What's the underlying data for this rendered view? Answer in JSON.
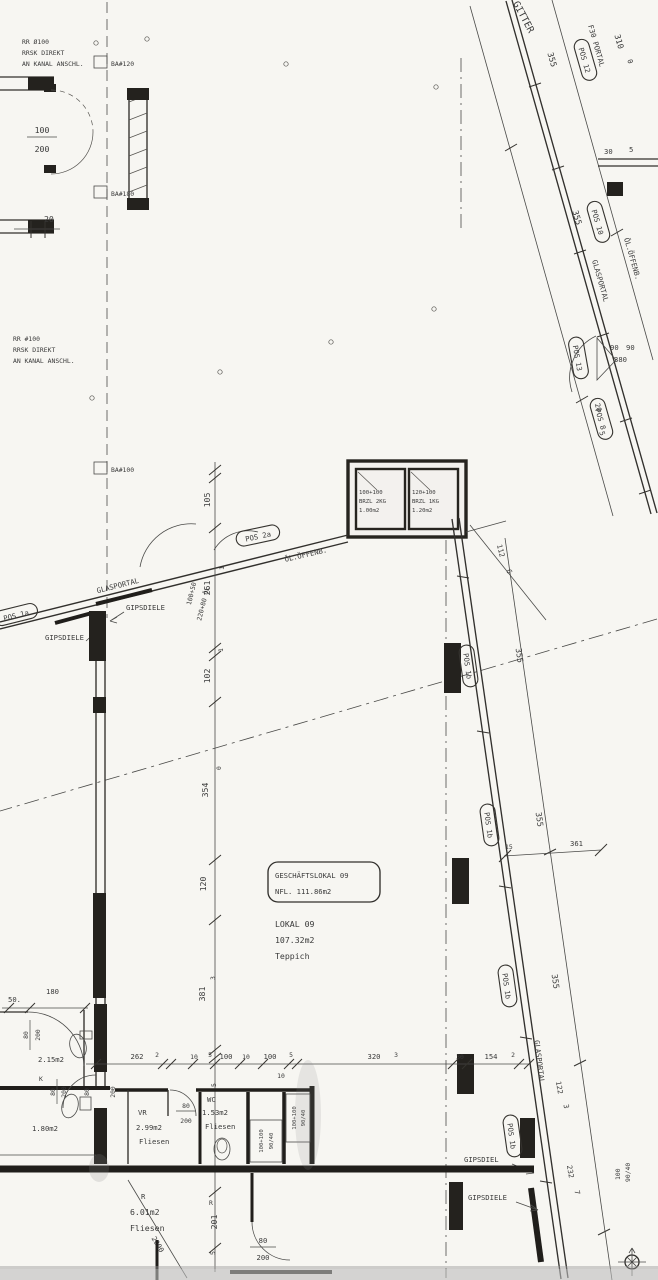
{
  "colors": {
    "ink": "#3a3a3a",
    "wall": "#201e1b",
    "paper": "#f7f6f2"
  },
  "labels": {
    "top_left": {
      "note1": [
        "RR Ø100",
        "RRSK DIREKT",
        "AN KANAL ANSCHL."
      ],
      "note2": [
        "RR #100",
        "RRSK DIREKT",
        "AN KANAL ANSCHL."
      ],
      "ba_120": "BA#120",
      "ba_180": "BA#180",
      "ba_100": "BA#100",
      "door_w": "100",
      "door_h": "200",
      "dim_20": "20"
    },
    "top_right": {
      "gitter": "GITTER",
      "f30": "F30 PORTAL",
      "d310": "310",
      "d0": "0",
      "d355_a": "355",
      "d355_b": "355",
      "pos_12": "POS 12",
      "pos_10": "POS 10",
      "pos_8": "POS 8",
      "pos_13": "POS 13",
      "glasportal": "GLASPORTAL",
      "oeffenb": "ÖL.ÖFFENB.",
      "d30": "30",
      "d5a": "5",
      "d90a": "90",
      "d90b": "90",
      "d380": "380",
      "d20": "20",
      "d5b": "5",
      "d112": "112",
      "d6": "6"
    },
    "shaft_boxes": {
      "left": [
        "100+100",
        "BRZL 2KG",
        "1.00m2"
      ],
      "right": [
        "120+100",
        "BRZL 1KG",
        "1.20m2"
      ]
    },
    "entrance": {
      "pos_1a": "POS 1a",
      "pos_2a": "POS 2a",
      "glasportal": "GLASPORTAL",
      "gipsdiele_a": "GIPSDIELE",
      "gipsdiele_b": "GIPSDIELE",
      "oeffenb": "ÖL.ÖFFENB.",
      "door_a": "100+50",
      "door_b": "220+80 ÖL"
    },
    "vchain": {
      "d105": "105",
      "s1a": "1",
      "d261": "261",
      "s1b": "1",
      "d102": "102",
      "s0": "0",
      "d354": "354",
      "d120": "120",
      "s3": "3",
      "d381": "381",
      "s5a": "5",
      "sR": "R",
      "d201": "201",
      "s5b": "5"
    },
    "room": {
      "title": "GESCHÄFTSLOKAL 09",
      "nfl": "NFL. 111.86m2",
      "lokal": "LOKAL 09",
      "area": "107.32m2",
      "floor": "Teppich"
    },
    "right_wall": {
      "pos_1b_1": "POS 1b",
      "pos_1b_2": "POS 1b",
      "pos_1b_3": "POS 1b",
      "pos_1b_4": "POS 1b",
      "d355_1": "355",
      "d355_2": "355",
      "d355_3": "355",
      "d361": "361",
      "d15": "15",
      "glasportal": "GLASPORTAL",
      "d122": "122",
      "s3": "3",
      "d232": "232",
      "s7": "7",
      "gipsdiel": "GIPSDIEL",
      "gipsdiele": "GIPSDIELE",
      "shaft_a": "100",
      "shaft_b": "90/40"
    },
    "hchain": {
      "d262": "262",
      "s2a": "2",
      "d10a": "10",
      "s5a": "5",
      "d100a": "100",
      "d10b": "10",
      "d100b": "100",
      "s5b": "5",
      "b10": "10",
      "d320": "320",
      "s3": "3",
      "d30": "30",
      "d154": "154",
      "s2b": "2"
    },
    "bottom_left": {
      "d50": "50.",
      "d180": "180",
      "f80": "80",
      "f200": "200",
      "area1": "2.15m2",
      "k": "K",
      "k80": "80",
      "k200": "200",
      "area2": "1.80m2",
      "wd80": "80",
      "wd200": "200"
    },
    "bottom_mid": {
      "vr": "VR",
      "f80": "80",
      "f200": "200",
      "area_vr": "2.99m2",
      "fl1": "Fliesen",
      "wc": "WC",
      "area_wc": "1.53m2",
      "fl2": "Fliesen",
      "n1a": "100+100",
      "n1b": "90/40",
      "n2a": "100+100",
      "n2b": "90/40",
      "r": "R",
      "area_r": "6.01m2",
      "fl3": "Fliesen",
      "d2000": "2000",
      "f80b": "80",
      "f200b": "200"
    }
  }
}
